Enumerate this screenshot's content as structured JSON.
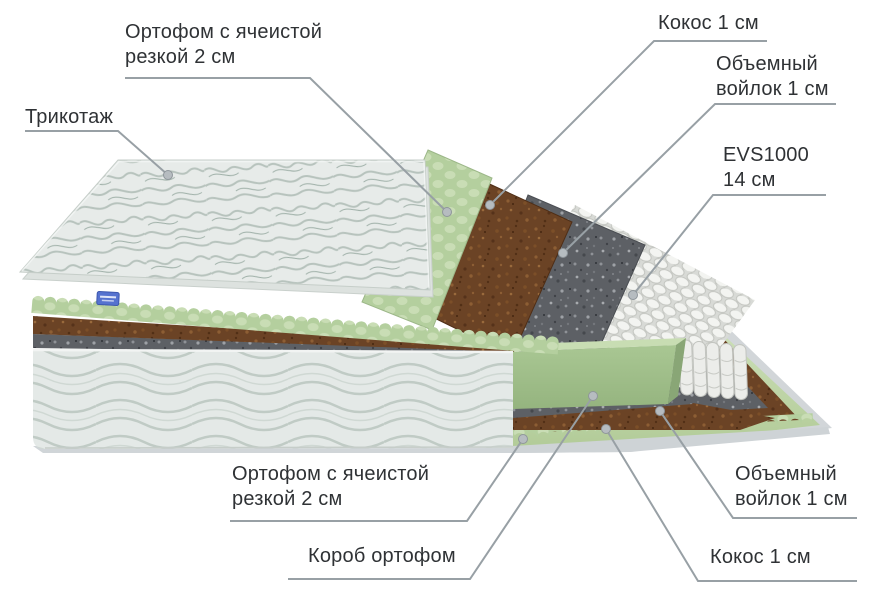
{
  "diagram": {
    "type": "mattress-layers-cutaway",
    "colors": {
      "label_text": "#2f3235",
      "leader_line": "#98a0a5",
      "leader_dot": "#b6bcc0",
      "foam_green": "#b4cf9e",
      "coconut_brown": "#6b4325",
      "felt_gray": "#5d6065",
      "quilt_white": "#e6eae8",
      "spring_white": "#f3f4f1",
      "brand_tag_blue": "#5572cf"
    },
    "layer_names": [
      "Трикотаж",
      "Ортофом с ячеистой резкой 2 см",
      "Кокос 1 см",
      "Объемный войлок 1 см",
      "EVS1000 14 см",
      "Короб ортофом"
    ],
    "labels": [
      {
        "id": "trikotazh",
        "lines": [
          "Трикотаж"
        ],
        "x": 25,
        "y": 105,
        "leader": [
          [
            25,
            131
          ],
          [
            118,
            131
          ],
          [
            168,
            175
          ]
        ]
      },
      {
        "id": "ortofom-top",
        "lines": [
          "Ортофом с ячеистой",
          "резкой 2 см"
        ],
        "x": 125,
        "y": 20,
        "leader": [
          [
            125,
            78
          ],
          [
            310,
            78
          ],
          [
            447,
            212
          ]
        ]
      },
      {
        "id": "kokos-top",
        "lines": [
          "Кокос 1 см"
        ],
        "x": 658,
        "y": 11,
        "leader": [
          [
            767,
            41
          ],
          [
            654,
            41
          ],
          [
            490,
            205
          ]
        ]
      },
      {
        "id": "voylok-top",
        "lines": [
          "Объемный",
          "войлок 1 см"
        ],
        "x": 716,
        "y": 52,
        "leader": [
          [
            836,
            104
          ],
          [
            715,
            104
          ],
          [
            563,
            253
          ]
        ]
      },
      {
        "id": "evs1000",
        "lines": [
          "EVS1000",
          "14 см"
        ],
        "x": 723,
        "y": 143,
        "leader": [
          [
            826,
            195
          ],
          [
            713,
            195
          ],
          [
            633,
            295
          ]
        ]
      },
      {
        "id": "ortofom-bottom",
        "lines": [
          "Ортофом с ячеистой",
          "резкой 2 см"
        ],
        "x": 232,
        "y": 462,
        "leader": [
          [
            230,
            521
          ],
          [
            467,
            521
          ],
          [
            523,
            439
          ]
        ]
      },
      {
        "id": "korob",
        "lines": [
          "Короб ортофом"
        ],
        "x": 308,
        "y": 544,
        "leader": [
          [
            288,
            579
          ],
          [
            470,
            579
          ],
          [
            593,
            396
          ]
        ]
      },
      {
        "id": "voylok-bottom",
        "lines": [
          "Объемный",
          "войлок 1 см"
        ],
        "x": 735,
        "y": 462,
        "leader": [
          [
            857,
            518
          ],
          [
            733,
            518
          ],
          [
            660,
            411
          ]
        ]
      },
      {
        "id": "kokos-bottom",
        "lines": [
          "Кокос 1 см"
        ],
        "x": 710,
        "y": 545,
        "leader": [
          [
            857,
            581
          ],
          [
            698,
            581
          ],
          [
            606,
            429
          ]
        ]
      }
    ]
  }
}
